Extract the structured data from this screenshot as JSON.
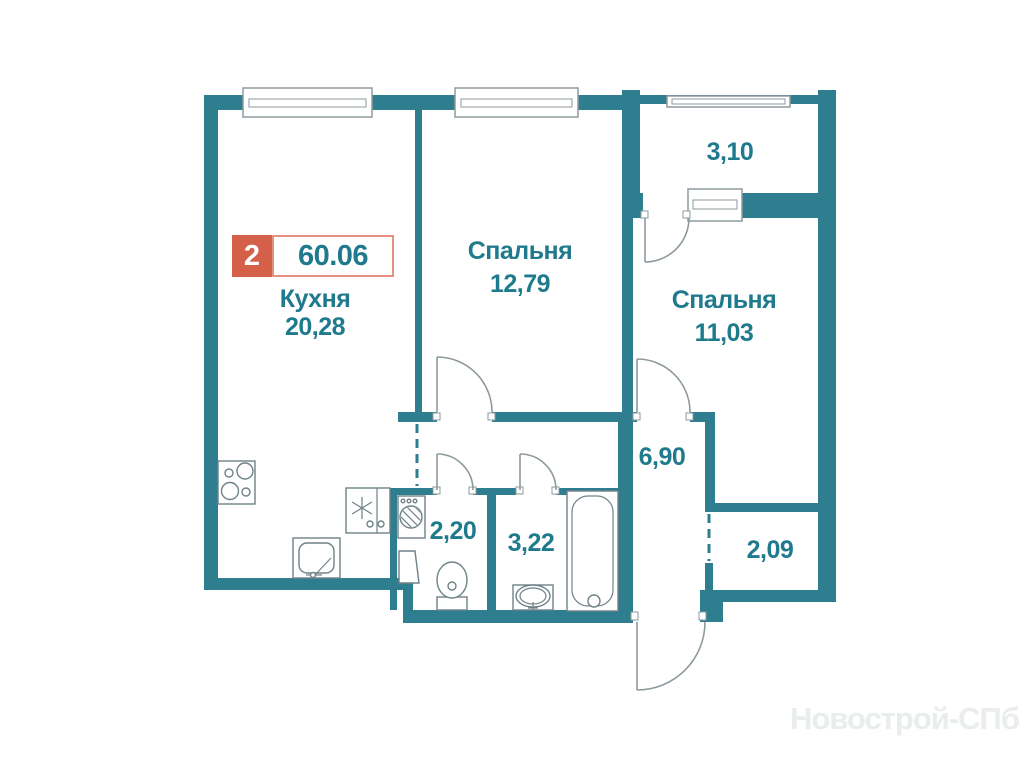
{
  "floor_plan": {
    "badge": {
      "rooms": "2",
      "area": "60.06"
    },
    "rooms": {
      "kitchen": {
        "name": "Кухня",
        "area": "20,28"
      },
      "bedroom1": {
        "name": "Спальня",
        "area": "12,79"
      },
      "bedroom2": {
        "name": "Спальня",
        "area": "11,03"
      },
      "balcony": {
        "area": "3,10"
      },
      "hallway": {
        "area": "6,90"
      },
      "wc": {
        "area": "2,20"
      },
      "bathroom": {
        "area": "3,22"
      },
      "wardrobe": {
        "area": "2,09"
      }
    },
    "watermark": "Новострой-СПб",
    "colors": {
      "wall": "#2F7E90",
      "label": "#1E7A8C",
      "badge_bg": "#D4604A",
      "badge_border": "#E59080"
    },
    "fixtures": [
      "stove",
      "kitchen-sink",
      "fridge",
      "washing-machine",
      "toilet",
      "washbasin",
      "bathtub"
    ]
  }
}
